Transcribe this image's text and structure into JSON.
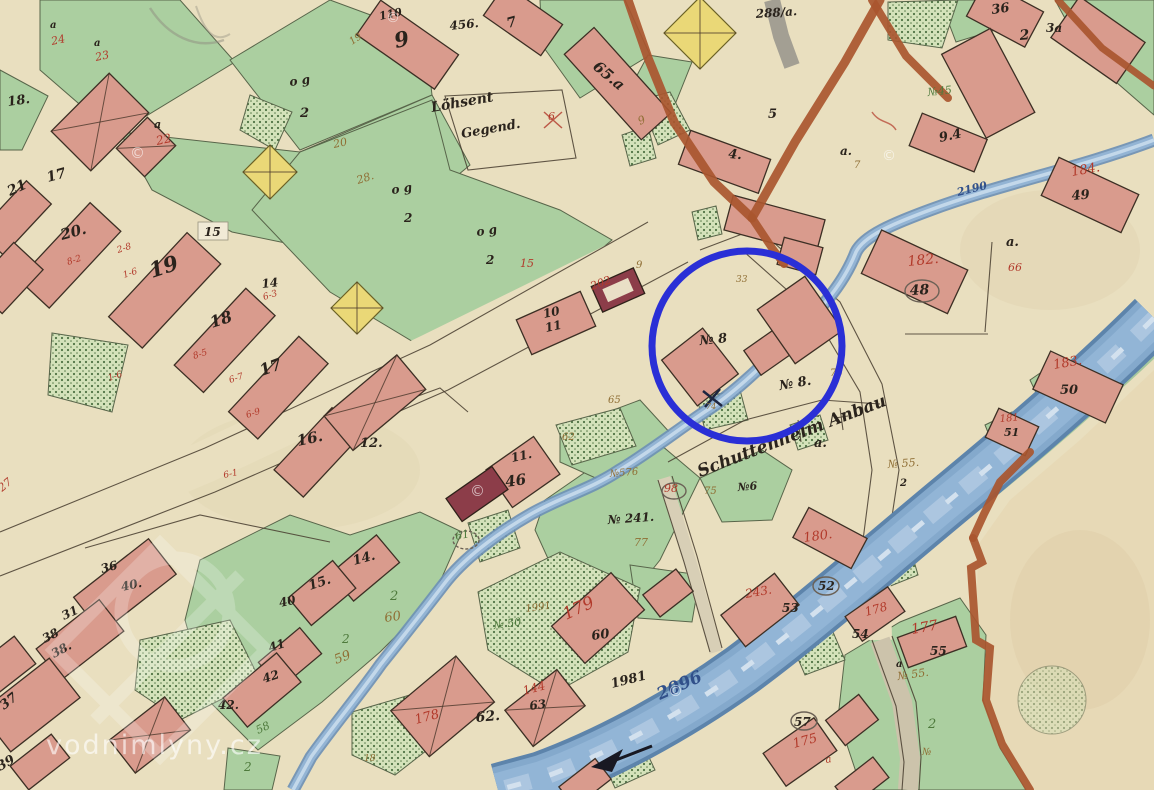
{
  "highlight": {
    "shape": "circle",
    "cx": 747,
    "cy": 346,
    "r": 95,
    "color": "#2a2fd6",
    "stroke_width": 7,
    "around_label": "№ 8"
  },
  "watermark": {
    "site_text": "vodnimlyny.cz",
    "copyright_symbol": "©"
  },
  "colors": {
    "ink": "#2a231c",
    "red_script": "#b23a2b",
    "brown_script": "#8f6e34",
    "green_script": "#4e7a3c",
    "blue_script": "#4a6fa8",
    "water_number": "#31508a",
    "highlight": "#2a2fd6",
    "paper": "#e9dfbf",
    "water": "#8fb2d5",
    "building": "#d99b8d",
    "building_dark": "#8c3d49",
    "field_green": "#abcfa0",
    "road_brown": "#a9562f",
    "watermark_white": "rgba(255,255,255,0.62)"
  },
  "labels": [
    {
      "t": "18.",
      "x": 8,
      "y": 106,
      "s": 13,
      "r": -8
    },
    {
      "t": "21",
      "x": 10,
      "y": 196,
      "s": 14,
      "r": -25
    },
    {
      "t": "17",
      "x": 48,
      "y": 182,
      "s": 14,
      "r": -15
    },
    {
      "t": "20.",
      "x": 62,
      "y": 240,
      "s": 15,
      "r": -15
    },
    {
      "t": "19",
      "x": 152,
      "y": 278,
      "s": 21,
      "r": -18
    },
    {
      "t": "18",
      "x": 212,
      "y": 328,
      "s": 16,
      "r": -18
    },
    {
      "t": "17",
      "x": 262,
      "y": 376,
      "s": 16,
      "r": -20
    },
    {
      "t": "16.",
      "x": 298,
      "y": 446,
      "s": 15,
      "r": -12
    },
    {
      "t": "12.",
      "x": 360,
      "y": 447,
      "s": 13
    },
    {
      "t": "15",
      "x": 204,
      "y": 236
    },
    {
      "t": "14",
      "x": 262,
      "y": 288,
      "r": -6
    },
    {
      "t": "110",
      "x": 380,
      "y": 20,
      "s": 11,
      "r": -12
    },
    {
      "t": "9",
      "x": 396,
      "y": 48,
      "s": 21,
      "r": -12
    },
    {
      "t": "456.",
      "x": 450,
      "y": 30,
      "r": -6
    },
    {
      "t": "7",
      "x": 508,
      "y": 28,
      "s": 14,
      "r": -15
    },
    {
      "t": "65.a",
      "x": 592,
      "y": 68,
      "s": 15,
      "r": 40
    },
    {
      "t": "4.",
      "x": 728,
      "y": 158,
      "s": 13,
      "r": 5
    },
    {
      "t": "5",
      "x": 768,
      "y": 118,
      "s": 13
    },
    {
      "t": "a.",
      "x": 840,
      "y": 155
    },
    {
      "t": "7",
      "x": 854,
      "y": 168,
      "s": 10,
      "c": "brown"
    },
    {
      "t": "36",
      "x": 992,
      "y": 14,
      "s": 13,
      "r": -8
    },
    {
      "t": "2",
      "x": 1020,
      "y": 40,
      "s": 14,
      "r": -5
    },
    {
      "t": "3a",
      "x": 1046,
      "y": 32
    },
    {
      "t": "9.4",
      "x": 940,
      "y": 142,
      "s": 13,
      "r": -12
    },
    {
      "t": "184.",
      "x": 1072,
      "y": 176,
      "s": 13,
      "r": -10,
      "c": "red"
    },
    {
      "t": "49",
      "x": 1072,
      "y": 200,
      "s": 13,
      "r": -5
    },
    {
      "t": "a.",
      "x": 1006,
      "y": 246,
      "s": 13
    },
    {
      "t": "66",
      "x": 1008,
      "y": 271,
      "s": 11,
      "c": "red"
    },
    {
      "t": "182.",
      "x": 908,
      "y": 266,
      "s": 14,
      "r": -6,
      "c": "red"
    },
    {
      "t": "48",
      "x": 910,
      "y": 295,
      "s": 14,
      "r": -3
    },
    {
      "t": "183.",
      "x": 1054,
      "y": 369,
      "s": 13,
      "r": -10,
      "c": "red"
    },
    {
      "t": "50",
      "x": 1060,
      "y": 394,
      "s": 13
    },
    {
      "t": "181",
      "x": 1000,
      "y": 422,
      "s": 10,
      "r": -5,
      "c": "red"
    },
    {
      "t": "51",
      "x": 1004,
      "y": 436,
      "s": 11
    },
    {
      "t": "180.",
      "x": 804,
      "y": 542,
      "s": 13,
      "r": -8,
      "c": "red"
    },
    {
      "t": "52",
      "x": 818,
      "y": 590
    },
    {
      "t": "243.",
      "x": 746,
      "y": 598,
      "r": -10,
      "c": "red"
    },
    {
      "t": "53",
      "x": 782,
      "y": 612
    },
    {
      "t": "178",
      "x": 866,
      "y": 616,
      "r": -15,
      "c": "red"
    },
    {
      "t": "54",
      "x": 852,
      "y": 638
    },
    {
      "t": "177",
      "x": 912,
      "y": 634,
      "s": 14,
      "r": -10,
      "c": "red"
    },
    {
      "t": "55",
      "x": 930,
      "y": 655
    },
    {
      "t": "№ 55.",
      "x": 888,
      "y": 468,
      "s": 11,
      "r": -4,
      "c": "brown"
    },
    {
      "t": "2",
      "x": 900,
      "y": 486,
      "s": 10
    },
    {
      "t": "№ 55.",
      "x": 898,
      "y": 680,
      "s": 11,
      "r": -8,
      "c": "brown"
    },
    {
      "t": "a",
      "x": 896,
      "y": 667,
      "s": 10
    },
    {
      "t": "2",
      "x": 928,
      "y": 728,
      "s": 13,
      "c": "green"
    },
    {
      "t": "№",
      "x": 922,
      "y": 755,
      "s": 10,
      "c": "brown"
    },
    {
      "t": "57",
      "x": 794,
      "y": 726
    },
    {
      "t": "175",
      "x": 794,
      "y": 748,
      "s": 13,
      "r": -15,
      "c": "red"
    },
    {
      "t": "a",
      "x": 826,
      "y": 763,
      "s": 10,
      "r": -10,
      "c": "red"
    },
    {
      "t": "10",
      "x": 544,
      "y": 318,
      "r": -12
    },
    {
      "t": "11",
      "x": 546,
      "y": 332,
      "r": -12
    },
    {
      "t": "11.",
      "x": 512,
      "y": 462,
      "r": -12
    },
    {
      "t": "46",
      "x": 506,
      "y": 487,
      "s": 15,
      "r": -8
    },
    {
      "t": "202",
      "x": 592,
      "y": 290,
      "s": 11,
      "r": -20,
      "c": "red"
    },
    {
      "t": "9",
      "x": 636,
      "y": 268,
      "s": 10,
      "c": "brown"
    },
    {
      "t": "№ 8",
      "x": 700,
      "y": 345,
      "s": 13,
      "r": -6
    },
    {
      "t": "№ 8.",
      "x": 780,
      "y": 390,
      "s": 13,
      "r": -10
    },
    {
      "t": "75",
      "x": 830,
      "y": 376,
      "s": 10,
      "c": "brown"
    },
    {
      "t": "33",
      "x": 736,
      "y": 282,
      "s": 9,
      "c": "brown"
    },
    {
      "t": "74",
      "x": 706,
      "y": 409,
      "s": 8,
      "c": "brown"
    },
    {
      "t": "98",
      "x": 664,
      "y": 492,
      "s": 11,
      "c": "red"
    },
    {
      "t": "75",
      "x": 704,
      "y": 494,
      "s": 10,
      "c": "brown"
    },
    {
      "t": "№6",
      "x": 738,
      "y": 491,
      "s": 11,
      "r": -5
    },
    {
      "t": "№576",
      "x": 610,
      "y": 477,
      "s": 10,
      "r": -5,
      "c": "brown"
    },
    {
      "t": "65",
      "x": 608,
      "y": 403,
      "s": 10,
      "c": "brown"
    },
    {
      "t": "62",
      "x": 562,
      "y": 440,
      "s": 10,
      "c": "brown"
    },
    {
      "t": "№ 241.",
      "x": 608,
      "y": 524,
      "r": -4
    },
    {
      "t": "77",
      "x": 634,
      "y": 546,
      "s": 11,
      "c": "brown"
    },
    {
      "t": "179",
      "x": 566,
      "y": 620,
      "s": 17,
      "r": -25,
      "c": "red"
    },
    {
      "t": "60",
      "x": 592,
      "y": 640,
      "s": 13,
      "r": -8
    },
    {
      "t": "59",
      "x": 336,
      "y": 664,
      "s": 13,
      "r": -20,
      "c": "brown"
    },
    {
      "t": "60",
      "x": 385,
      "y": 622,
      "s": 13,
      "r": -8,
      "c": "brown"
    },
    {
      "t": "2",
      "x": 390,
      "y": 600,
      "s": 13,
      "c": "green"
    },
    {
      "t": "2",
      "x": 342,
      "y": 643,
      "c": "green"
    },
    {
      "t": "58",
      "x": 258,
      "y": 734,
      "s": 11,
      "r": -25,
      "c": "green"
    },
    {
      "t": "2",
      "x": 244,
      "y": 771,
      "c": "green"
    },
    {
      "t": "61",
      "x": 456,
      "y": 540,
      "s": 11,
      "r": -12,
      "c": "green"
    },
    {
      "t": "№ 50",
      "x": 494,
      "y": 629,
      "s": 11,
      "r": -8,
      "c": "green"
    },
    {
      "t": "1991",
      "x": 526,
      "y": 612,
      "s": 10,
      "r": -8,
      "c": "brown"
    },
    {
      "t": "144",
      "x": 524,
      "y": 695,
      "r": -15,
      "c": "red"
    },
    {
      "t": "63",
      "x": 530,
      "y": 710,
      "r": -8
    },
    {
      "t": "62.",
      "x": 476,
      "y": 722,
      "s": 14,
      "r": -5
    },
    {
      "t": "178",
      "x": 416,
      "y": 724,
      "s": 13,
      "r": -15,
      "c": "red"
    },
    {
      "t": "18",
      "x": 364,
      "y": 761,
      "s": 9,
      "c": "brown"
    },
    {
      "t": "1981",
      "x": 612,
      "y": 688,
      "s": 13,
      "r": -14
    },
    {
      "t": "2096",
      "x": 660,
      "y": 700,
      "s": 17,
      "r": -24,
      "c": "water"
    },
    {
      "t": "2190",
      "x": 958,
      "y": 196,
      "s": 11,
      "r": -14,
      "c": "water"
    },
    {
      "t": "Löhsent",
      "x": 432,
      "y": 112,
      "s": 14,
      "r": -10
    },
    {
      "t": "Gegend.",
      "x": 462,
      "y": 138,
      "s": 13,
      "r": -10
    },
    {
      "t": "Schuttenhelm Anbau",
      "x": 700,
      "y": 477,
      "s": 17,
      "r": -21
    },
    {
      "t": "a.",
      "x": 814,
      "y": 447,
      "s": 13
    },
    {
      "t": "o g",
      "x": 290,
      "y": 86,
      "r": -8
    },
    {
      "t": "2",
      "x": 300,
      "y": 117,
      "s": 13
    },
    {
      "t": "o g",
      "x": 392,
      "y": 194,
      "r": -8
    },
    {
      "t": "2",
      "x": 404,
      "y": 222
    },
    {
      "t": "o g",
      "x": 477,
      "y": 236,
      "r": -8
    },
    {
      "t": "2",
      "x": 486,
      "y": 264
    },
    {
      "t": "15",
      "x": 520,
      "y": 267,
      "s": 11,
      "c": "red"
    },
    {
      "t": "6",
      "x": 548,
      "y": 120,
      "s": 11,
      "c": "red"
    },
    {
      "t": "24",
      "x": 52,
      "y": 45,
      "s": 11,
      "r": -12,
      "c": "red"
    },
    {
      "t": "23",
      "x": 96,
      "y": 61,
      "s": 11,
      "r": -12,
      "c": "red"
    },
    {
      "t": "22",
      "x": 157,
      "y": 145,
      "r": -12,
      "c": "red"
    },
    {
      "t": "a",
      "x": 50,
      "y": 28,
      "s": 10
    },
    {
      "t": "a",
      "x": 94,
      "y": 46,
      "s": 10
    },
    {
      "t": "a",
      "x": 154,
      "y": 128,
      "s": 11
    },
    {
      "t": "19",
      "x": 352,
      "y": 45,
      "s": 10,
      "r": -35,
      "c": "brown"
    },
    {
      "t": "20",
      "x": 334,
      "y": 148,
      "s": 11,
      "r": -12,
      "c": "brown"
    },
    {
      "t": "28.",
      "x": 358,
      "y": 184,
      "s": 11,
      "r": -18,
      "c": "brown"
    },
    {
      "t": "9",
      "x": 640,
      "y": 125,
      "s": 11,
      "r": -25,
      "c": "brown"
    },
    {
      "t": "№45",
      "x": 928,
      "y": 96,
      "s": 11,
      "r": -6,
      "c": "green"
    },
    {
      "t": "288/a.",
      "x": 756,
      "y": 18,
      "r": -4
    },
    {
      "t": "27",
      "x": 2,
      "y": 492,
      "s": 11,
      "r": -40,
      "c": "red"
    },
    {
      "t": "8-2",
      "x": 68,
      "y": 265,
      "s": 9,
      "r": -18,
      "c": "red"
    },
    {
      "t": "2-8",
      "x": 118,
      "y": 253,
      "s": 9,
      "r": -18,
      "c": "red"
    },
    {
      "t": "1-6",
      "x": 124,
      "y": 278,
      "s": 9,
      "r": -18,
      "c": "red"
    },
    {
      "t": "1-6",
      "x": 109,
      "y": 381,
      "s": 9,
      "r": -18,
      "c": "red"
    },
    {
      "t": "6-3",
      "x": 264,
      "y": 300,
      "s": 9,
      "r": -18,
      "c": "red"
    },
    {
      "t": "8-5",
      "x": 194,
      "y": 359,
      "s": 9,
      "r": -18,
      "c": "red"
    },
    {
      "t": "6-7",
      "x": 230,
      "y": 383,
      "s": 9,
      "r": -18,
      "c": "red"
    },
    {
      "t": "6-9",
      "x": 247,
      "y": 418,
      "s": 9,
      "r": -18,
      "c": "red"
    },
    {
      "t": "6-1",
      "x": 224,
      "y": 478,
      "s": 9,
      "r": -12,
      "c": "red"
    },
    {
      "t": "36",
      "x": 102,
      "y": 573,
      "r": -15
    },
    {
      "t": "40.",
      "x": 122,
      "y": 591,
      "r": -12
    },
    {
      "t": "31",
      "x": 64,
      "y": 620,
      "r": -25
    },
    {
      "t": "38",
      "x": 45,
      "y": 643,
      "r": -28
    },
    {
      "t": "38.",
      "x": 54,
      "y": 658,
      "r": -28
    },
    {
      "t": "37",
      "x": 4,
      "y": 710,
      "s": 13,
      "r": -38
    },
    {
      "t": "39",
      "x": 0,
      "y": 771,
      "s": 13,
      "r": -30
    },
    {
      "t": "41",
      "x": 270,
      "y": 652,
      "r": -18
    },
    {
      "t": "42",
      "x": 264,
      "y": 683,
      "r": -18
    },
    {
      "t": "42.",
      "x": 218,
      "y": 709
    },
    {
      "t": "40",
      "x": 280,
      "y": 607,
      "r": -12
    },
    {
      "t": "15.",
      "x": 310,
      "y": 590,
      "s": 13,
      "r": -18
    },
    {
      "t": "14.",
      "x": 354,
      "y": 565,
      "s": 13,
      "r": -15
    },
    {
      "t": "©",
      "x": 130,
      "y": 158,
      "s": 15,
      "c": "wm"
    },
    {
      "t": "©",
      "x": 386,
      "y": 22,
      "s": 14,
      "c": "wm"
    },
    {
      "t": "©",
      "x": 470,
      "y": 496,
      "s": 15,
      "c": "wm"
    },
    {
      "t": "©",
      "x": 668,
      "y": 696,
      "s": 15,
      "c": "wm"
    },
    {
      "t": "©",
      "x": 882,
      "y": 160,
      "s": 14,
      "c": "wm"
    }
  ]
}
